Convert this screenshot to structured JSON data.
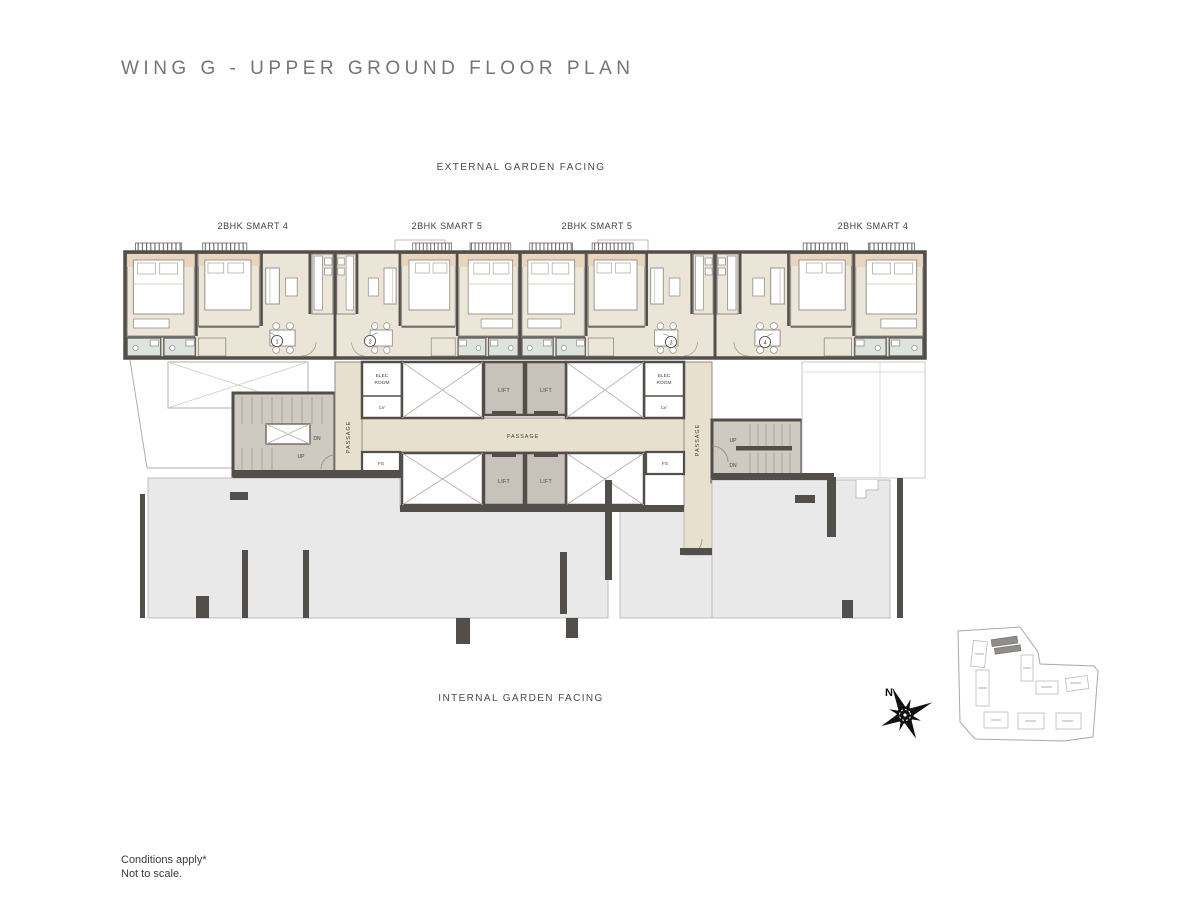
{
  "page": {
    "title": "WING G - UPPER GROUND FLOOR PLAN",
    "top_label": "EXTERNAL GARDEN FACING",
    "bottom_label": "INTERNAL GARDEN FACING",
    "footer_line1": "Conditions apply*",
    "footer_line2": "Not to scale."
  },
  "units": [
    {
      "label": "2BHK SMART 4",
      "entrance_no": "1"
    },
    {
      "label": "2BHK SMART 5",
      "entrance_no": "2"
    },
    {
      "label": "2BHK SMART 5",
      "entrance_no": "3"
    },
    {
      "label": "2BHK SMART 4",
      "entrance_no": "4"
    }
  ],
  "core": {
    "lift": "LIFT",
    "passage": "PASSAGE",
    "elec_room_line1": "ELEC",
    "elec_room_line2": "ROOM",
    "lv": "LV",
    "fs": "FS",
    "up": "UP",
    "dn": "DN"
  },
  "compass": {
    "north": "N"
  },
  "colors": {
    "wall": "#524e4a",
    "floor_cream": "#ebe5d8",
    "passage_cream": "#e7e0cf",
    "bath_green": "#dde4df",
    "beige_accent": "#e9d5bd",
    "lift_fill": "#c7c3ba",
    "stair_fill": "#cfcac1",
    "podium_gray": "#e9e9e9"
  }
}
